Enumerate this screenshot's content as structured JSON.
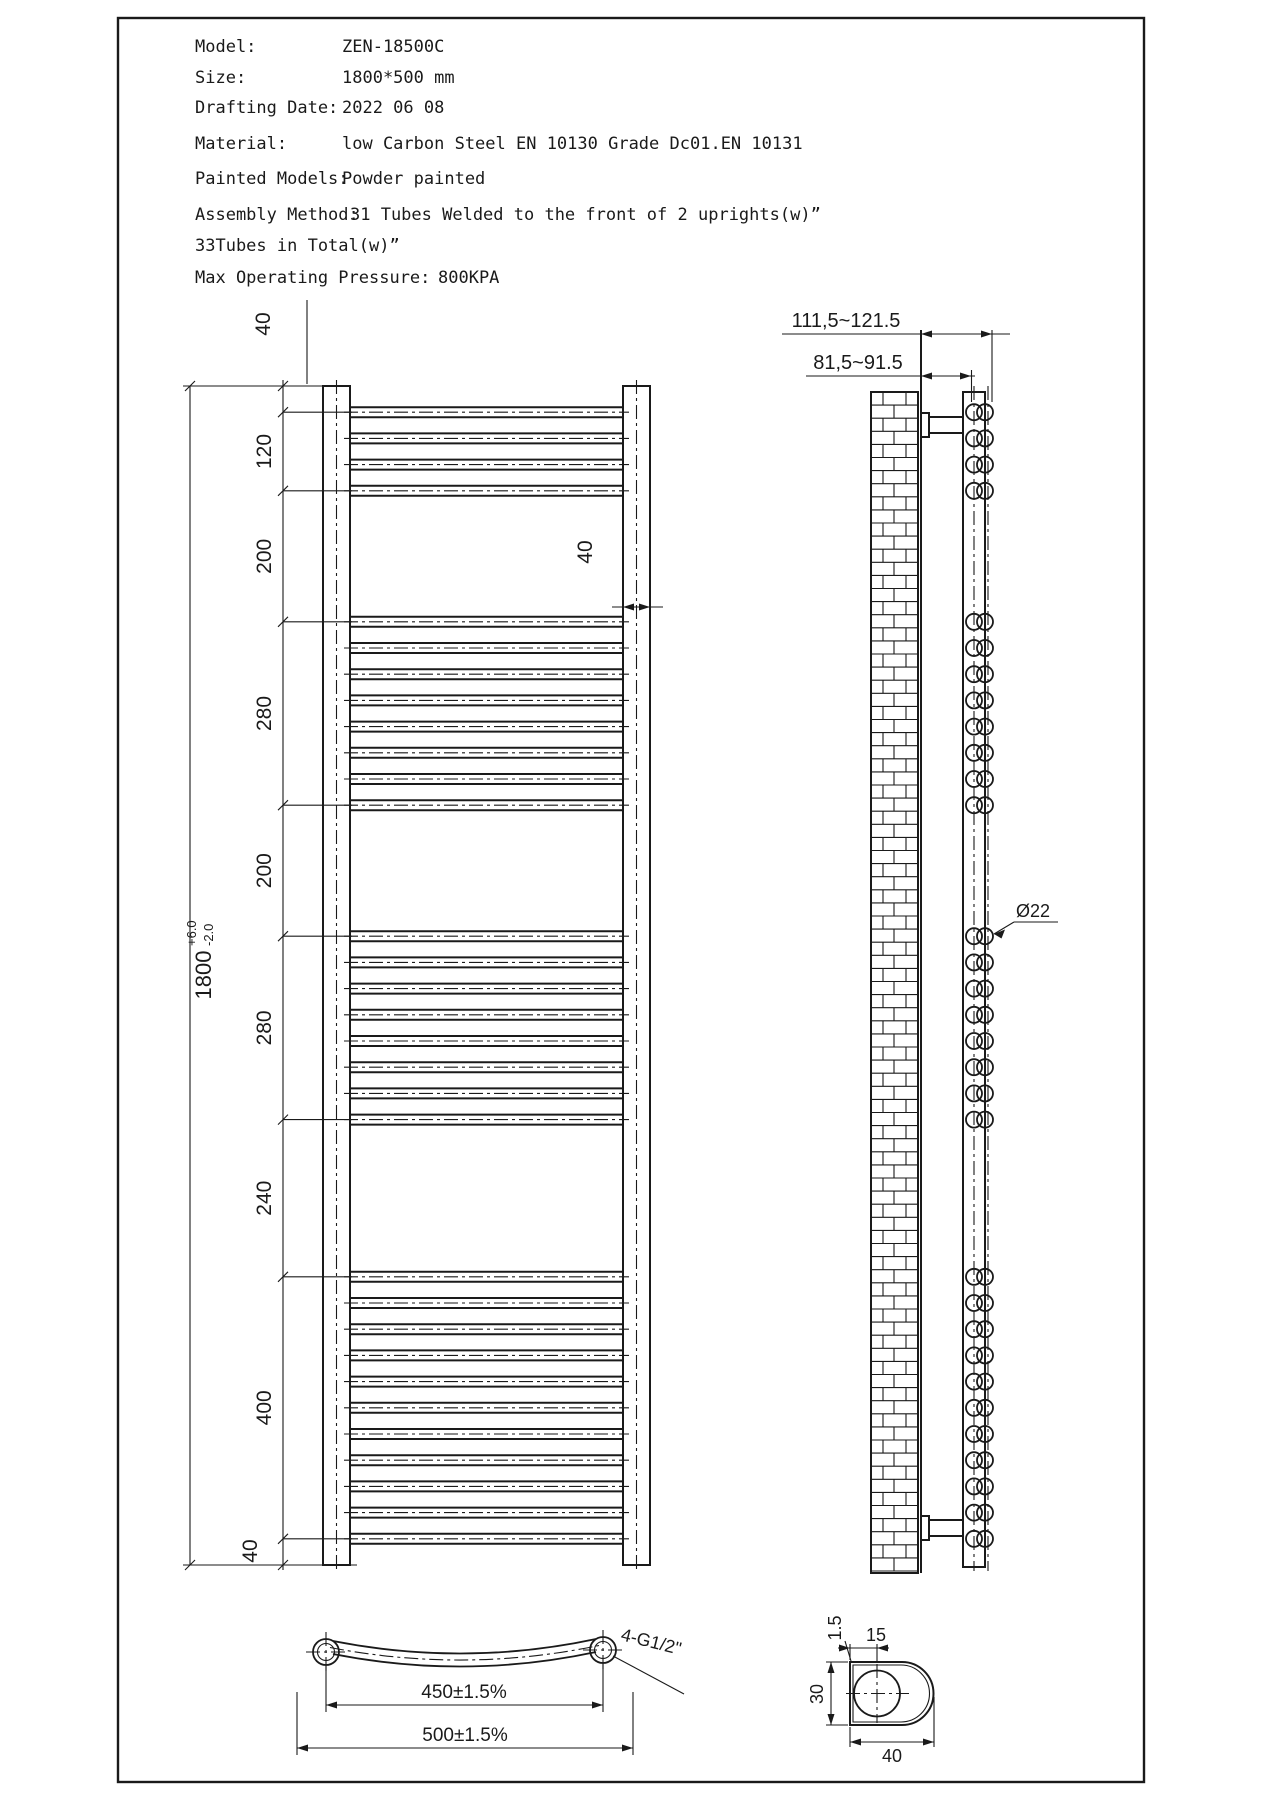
{
  "title_block": {
    "rows": [
      {
        "label": "Model:",
        "value": "ZEN-18500C"
      },
      {
        "label": "Size:",
        "value": "1800*500 mm"
      },
      {
        "label": "Drafting Date:",
        "value": "2022 06 08"
      },
      {
        "label": "Material:",
        "value": "low Carbon Steel  EN 10130 Grade Dc01.EN 10131"
      },
      {
        "label": "Painted Models:",
        "value": "Powder painted"
      },
      {
        "label": "Assembly Method:",
        "value": "31 Tubes Welded to the front of 2 uprights(w)”"
      },
      {
        "label": "33Tubes in Total(w)”",
        "value": ""
      },
      {
        "label": "Max Operating Pressure:",
        "value": "800KPA"
      }
    ]
  },
  "front_view": {
    "dim_chain": [
      "40",
      "120",
      "200",
      "280",
      "200",
      "280",
      "240",
      "400",
      "40"
    ],
    "overall": {
      "value": "1800",
      "tol_up": "+6.0",
      "tol_dn": "-2.0"
    },
    "upright_width": "40",
    "pitch_mm": 40,
    "banks": [
      {
        "count": 4,
        "start_mm": 40
      },
      {
        "count": 8,
        "start_mm": 360
      },
      {
        "count": 8,
        "start_mm": 840
      },
      {
        "count": 11,
        "start_mm": 1360
      }
    ]
  },
  "side_view": {
    "wall_to_front": "111,5~121.5",
    "wall_to_upright": "81,5~91.5",
    "tube_diameter": "Ø22"
  },
  "bottom_view": {
    "port_centers": "450±1.5%",
    "overall_width": "500±1.5%",
    "fittings": "4-G1/2\""
  },
  "section_view": {
    "wall_thickness": "1.5",
    "port_offset": "15",
    "width": "30",
    "depth": "40"
  },
  "colors": {
    "ink": "#1a1a1a",
    "paper": "#ffffff"
  }
}
